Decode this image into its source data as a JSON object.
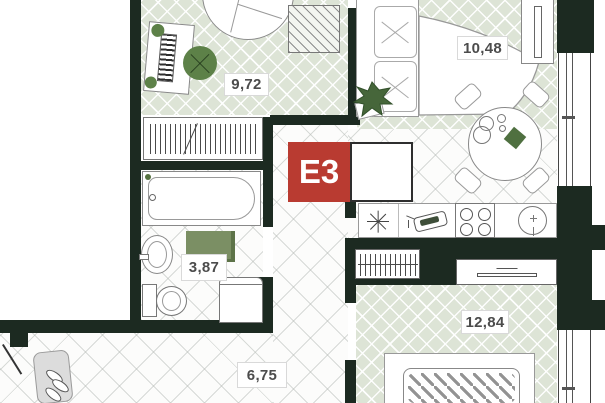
{
  "plan": {
    "title": "apartment floor plan",
    "unit_badge": {
      "code": "E3",
      "bg": "#b93b31",
      "text_color": "#ffffff"
    },
    "rooms": [
      {
        "id": "study-bedroom",
        "area": "9,72"
      },
      {
        "id": "living-kitchen",
        "area": "10,48"
      },
      {
        "id": "bathroom",
        "area": "3,87"
      },
      {
        "id": "hallway",
        "area": "6,75"
      },
      {
        "id": "bedroom",
        "area": "12,84"
      }
    ],
    "colors": {
      "wall": "#1c2a21",
      "badge_red": "#b93b31",
      "floor_wood_green": "#dde4d6",
      "furniture_green": "#5d8148",
      "plant_green": "#46663a"
    },
    "symbols": [
      "bathtub",
      "wash-basin",
      "toilet",
      "washing-machine",
      "bath-mat",
      "wardrobe",
      "closet-hangers",
      "desk",
      "pouf",
      "round-armchair",
      "sofa",
      "plant",
      "dining-table",
      "chairs",
      "tv-unit",
      "kitchen-counter",
      "kitchen-sink-star",
      "faucet",
      "cooktop",
      "round-sink",
      "tv-shelf",
      "bed",
      "entry-door",
      "shoe-bench",
      "window"
    ]
  }
}
